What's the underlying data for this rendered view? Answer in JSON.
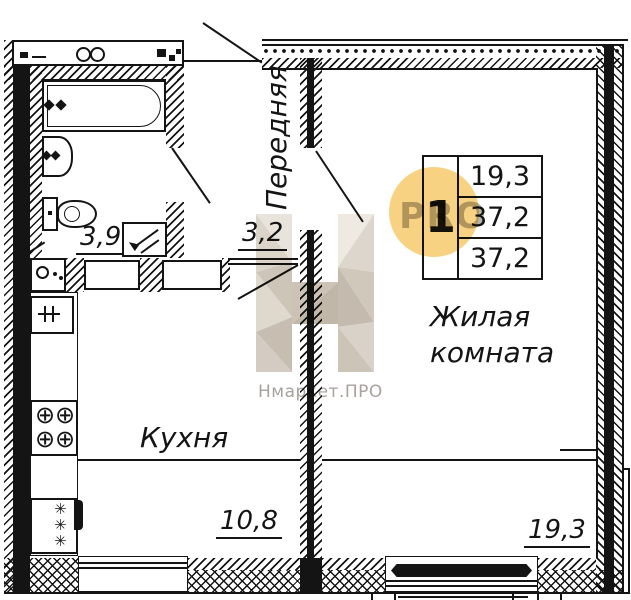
{
  "title": "apartment-floor-plan",
  "rooms": {
    "hallway_label": "Передняя",
    "hallway_area": "3,2",
    "bathroom_area": "3,9",
    "kitchen_label": "Кухня",
    "kitchen_area": "10,8",
    "living_label_line1": "Жилая",
    "living_label_line2": "комната",
    "living_area": "19,3"
  },
  "info_table": {
    "apartment_number": "1",
    "r1": "19,3",
    "r2": "37,2",
    "r3": "37,2"
  },
  "watermark": {
    "pro_text": "PRO",
    "brand_text": "Нмаркет.ПРО"
  },
  "icons": {
    "stove_burner": "⊕",
    "fridge_snowflake": "✳"
  },
  "colors": {
    "accent_yellow": "#F7CE78",
    "line_black": "#141414",
    "watermark_grey": "#A6A19B",
    "logo_beige": "#CFC7BA"
  }
}
